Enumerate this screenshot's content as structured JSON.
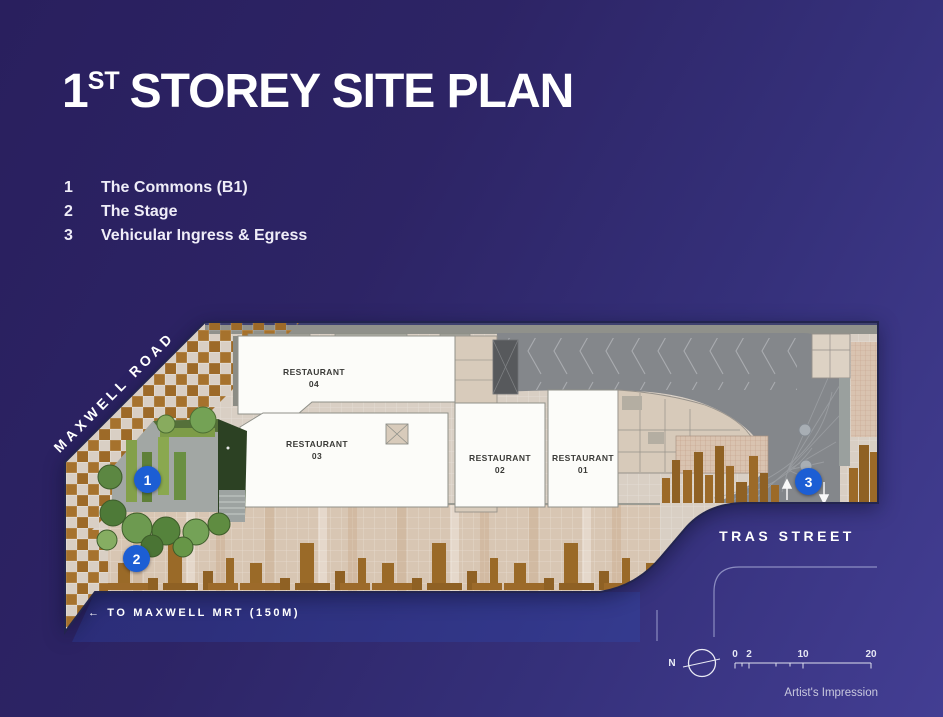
{
  "title": {
    "number": "1",
    "ordinal": "ST",
    "text": "STOREY SITE PLAN"
  },
  "legend": [
    {
      "num": "1",
      "label": "The Commons (B1)"
    },
    {
      "num": "2",
      "label": "The Stage"
    },
    {
      "num": "3",
      "label": "Vehicular Ingress & Egress"
    }
  ],
  "plan": {
    "roads": {
      "maxwell": "MAXWELL ROAD",
      "tras": "TRAS STREET"
    },
    "mrt_note": "← TO MAXWELL MRT (150M)",
    "restaurants": [
      {
        "line1": "RESTAURANT",
        "line2": "04"
      },
      {
        "line1": "RESTAURANT",
        "line2": "03"
      },
      {
        "line1": "RESTAURANT",
        "line2": "02"
      },
      {
        "line1": "RESTAURANT",
        "line2": "01"
      }
    ],
    "markers": [
      "1",
      "2",
      "3"
    ]
  },
  "compass": {
    "north": "N"
  },
  "scale_bar": {
    "ticks": [
      "0",
      "2",
      "10",
      "20"
    ]
  },
  "credit": "Artist's Impression",
  "colors": {
    "marker_blue": "#1c5ed4",
    "background_top_left": "#291f5e",
    "background_bottom_right": "#433e93",
    "paving_brown": "#a5712c",
    "plan_base": "#d9cfc4",
    "driveway_grey": "#84878b",
    "garden_green": "#4e7a38"
  }
}
